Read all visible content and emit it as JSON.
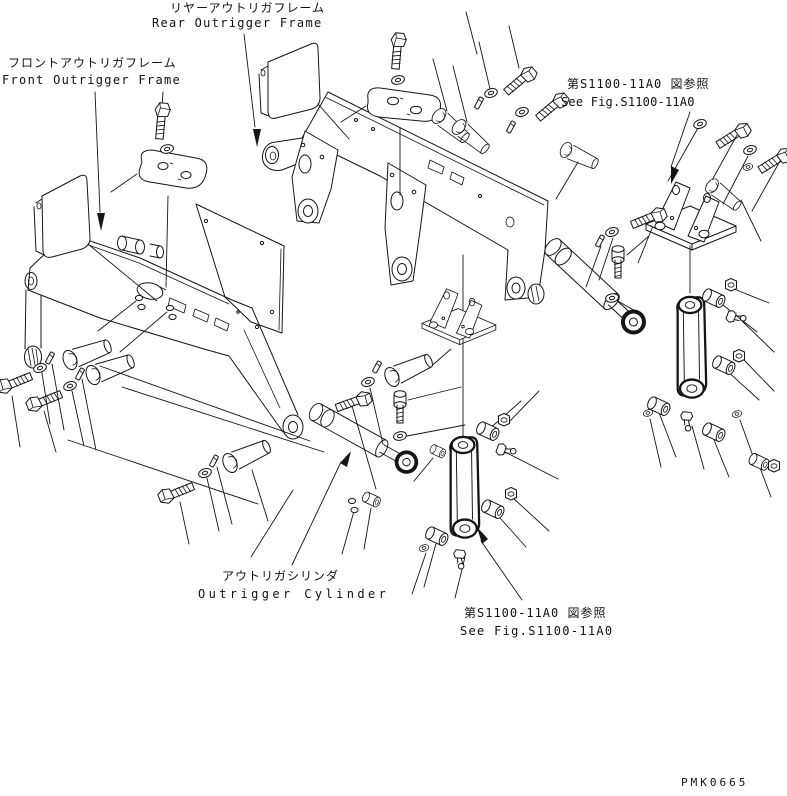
{
  "drawing": {
    "labels": {
      "rear_frame_jp": "リヤーアウトリガフレーム",
      "rear_frame_en": "Rear Outrigger Frame",
      "front_frame_jp": "フロントアウトリガフレーム",
      "front_frame_en": "Front Outrigger Frame",
      "fig_ref_right_jp": "第S1100-11A0 図参照",
      "fig_ref_right_en": "See Fig.S1100-11A0",
      "cylinder_jp": "アウトリガシリンダ",
      "cylinder_en": "Outrigger Cylinder",
      "fig_ref_bottom_jp": "第S1100-11A0 図参照",
      "fig_ref_bottom_en": "See Fig.S1100-11A0"
    },
    "part_code": "PMK0665",
    "colors": {
      "line": "#151515",
      "background": "#ffffff"
    },
    "components": [
      "front-outrigger-frame",
      "rear-outrigger-frame",
      "outrigger-cylinder-center",
      "outrigger-cylinder-right",
      "link-plate-center",
      "link-plate-right",
      "mounting-bracket-center",
      "mounting-bracket-right",
      "cover-plate-front",
      "cover-plate-rear",
      "top-plate-front",
      "top-plate-rear",
      "pins",
      "bolts",
      "washers",
      "keys",
      "bushings",
      "nuts",
      "grease-fittings"
    ]
  }
}
